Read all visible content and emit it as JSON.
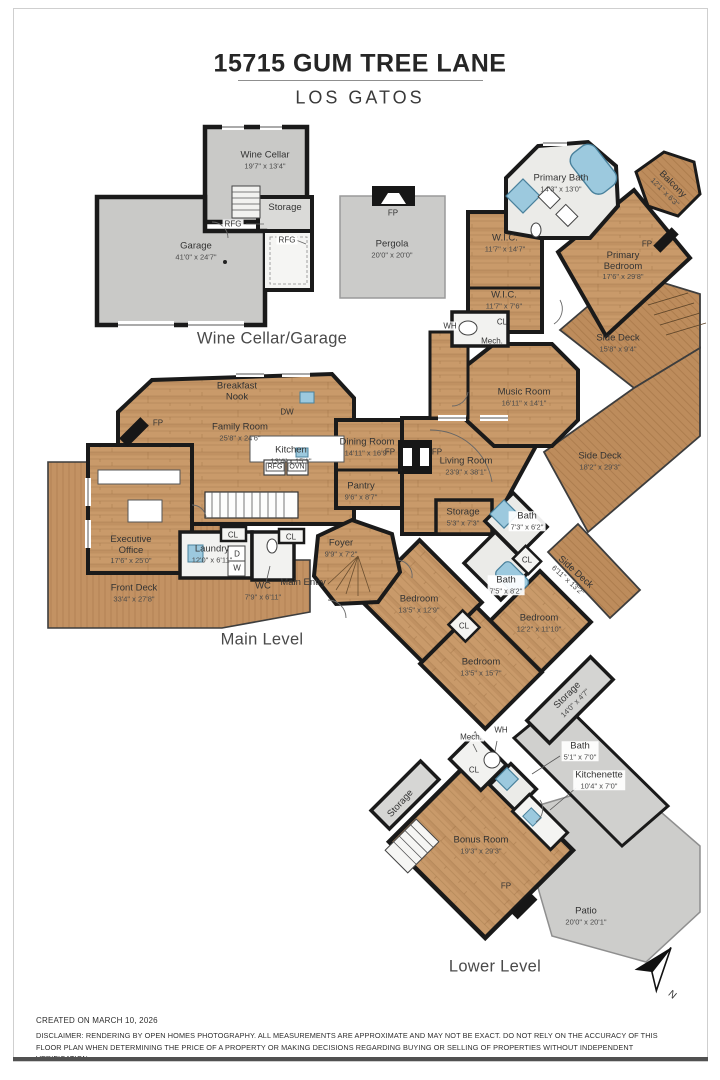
{
  "header": {
    "title": "15715 GUM TREE LANE",
    "subtitle": "LOS GATOS"
  },
  "sections": {
    "garage_level": "Wine Cellar/Garage",
    "main_level": "Main Level",
    "lower_level": "Lower Level"
  },
  "rooms": {
    "wine_cellar": {
      "name": "Wine Cellar",
      "dims": "19'7\" x 13'4\""
    },
    "garage_storage": {
      "name": "Storage"
    },
    "garage": {
      "name": "Garage",
      "dims": "41'0\" x 24'7\""
    },
    "pergola": {
      "name": "Pergola",
      "dims": "20'0\" x 20'0\""
    },
    "primary_bath": {
      "name": "Primary Bath",
      "dims": "14'3\" x 13'0\""
    },
    "balcony": {
      "name": "Balcony",
      "dims": "12'1\" x 6'3\""
    },
    "wic1": {
      "name": "W.I.C.",
      "dims": "11'7\" x 14'7\""
    },
    "wic2": {
      "name": "W.I.C.",
      "dims": "11'7\" x 7'6\""
    },
    "primary_bedroom": {
      "name": "Primary Bedroom",
      "dims": "17'6\" x 29'8\""
    },
    "side_deck_upper": {
      "name": "Side Deck",
      "dims": "15'8\" x 9'4\""
    },
    "music_room": {
      "name": "Music Room",
      "dims": "16'11\" x 14'1\""
    },
    "side_deck_right": {
      "name": "Side Deck",
      "dims": "18'2\" x 29'3\""
    },
    "breakfast_nook": {
      "name": "Breakfast Nook"
    },
    "family_room": {
      "name": "Family Room",
      "dims": "25'8\" x 24'6\""
    },
    "kitchen": {
      "name": "Kitchen",
      "dims": "13'4\" x 15'1\""
    },
    "dining_room": {
      "name": "Dining Room",
      "dims": "14'11\" x 16'9\""
    },
    "living_room": {
      "name": "Living Room",
      "dims": "23'9\" x 38'1\""
    },
    "pantry": {
      "name": "Pantry",
      "dims": "9'6\" x 8'7\""
    },
    "storage_main": {
      "name": "Storage",
      "dims": "5'3\" x 7'3\""
    },
    "bath_upper": {
      "name": "Bath",
      "dims": "7'3\" x 6'2\""
    },
    "bath_lower": {
      "name": "Bath",
      "dims": "7'5\" x 8'2\""
    },
    "side_deck_small": {
      "name": "Side Deck",
      "dims": "6'11\" x 13'2\""
    },
    "executive_office": {
      "name": "Executive Office",
      "dims": "17'6\" x 25'0\""
    },
    "front_deck": {
      "name": "Front Deck",
      "dims": "33'4\" x 27'8\""
    },
    "laundry": {
      "name": "Laundry",
      "dims": "12'0\" x 6'11\""
    },
    "wc": {
      "name": "WC",
      "dims": "7'9\" x 6'11\""
    },
    "foyer": {
      "name": "Foyer",
      "dims": "9'9\" x 7'2\""
    },
    "main_entry": {
      "name": "Main Entry"
    },
    "bedroom1": {
      "name": "Bedroom",
      "dims": "13'5\" x 12'9\""
    },
    "bedroom2": {
      "name": "Bedroom",
      "dims": "12'2\" x 11'10\""
    },
    "bedroom3": {
      "name": "Bedroom",
      "dims": "13'5\" x 15'7\""
    },
    "storage_lower_right": {
      "name": "Storage",
      "dims": "14'0\" x 4'7\""
    },
    "bath_lower_level": {
      "name": "Bath",
      "dims": "5'1\" x 7'0\""
    },
    "kitchenette": {
      "name": "Kitchenette",
      "dims": "10'4\" x 7'0\""
    },
    "storage_lower_left": {
      "name": "Storage"
    },
    "bonus_room": {
      "name": "Bonus Room",
      "dims": "19'3\" x 29'3\""
    },
    "patio": {
      "name": "Patio",
      "dims": "20'0\" x 20'1\""
    }
  },
  "annotations": {
    "fp": "FP",
    "dw": "DW",
    "rfg": "RFG",
    "ovn": "OVN",
    "wh": "WH",
    "mech": "Mech.",
    "cl": "CL",
    "d": "D",
    "w": "W",
    "north": "N"
  },
  "footer": {
    "created": "CREATED ON MARCH 10, 2026",
    "disclaimer": "DISCLAIMER: RENDERING BY OPEN HOMES PHOTOGRAPHY. ALL MEASUREMENTS ARE APPROXIMATE AND MAY NOT BE EXACT. DO NOT RELY ON THE ACCURACY OF THIS FLOOR PLAN WHEN DETERMINING THE PRICE OF A PROPERTY OR MAKING DECISIONS REGARDING BUYING OR SELLING OF PROPERTIES WITHOUT INDEPENDENT VERIFICATION."
  }
}
